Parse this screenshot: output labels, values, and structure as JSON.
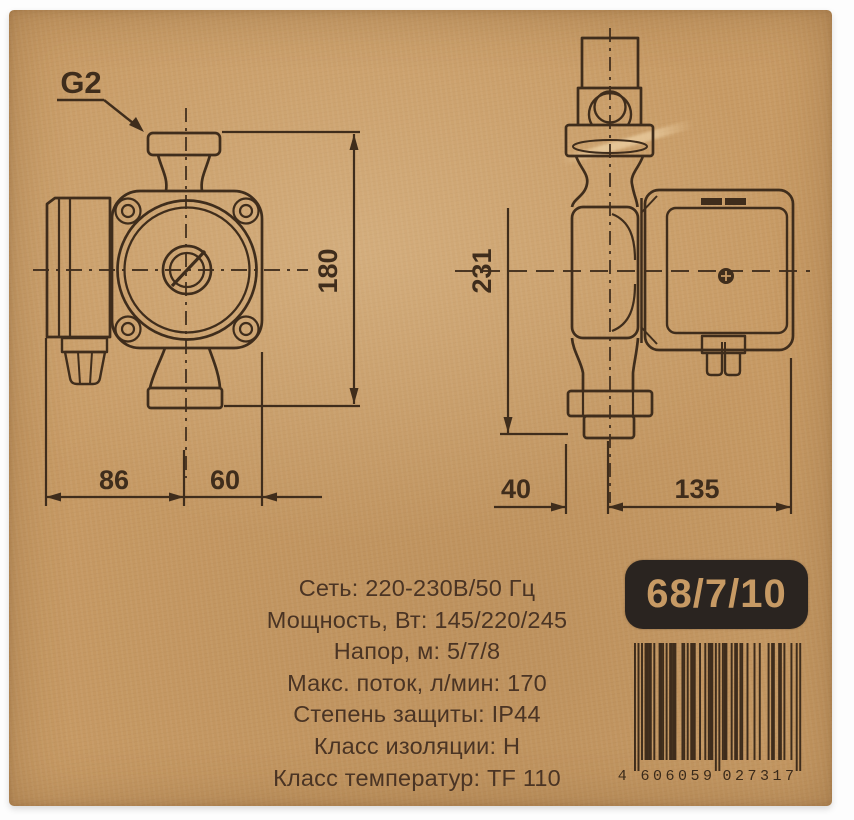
{
  "package": {
    "front_view": {
      "thread_label": "G2",
      "dim_height": "180",
      "dim_left": "86",
      "dim_right": "60"
    },
    "side_view": {
      "dim_height": "231",
      "dim_left": "40",
      "dim_right": "135"
    }
  },
  "specs": {
    "lines": [
      "Сеть: 220-230В/50 Гц",
      "Мощность, Вт: 145/220/245",
      "Напор, м: 5/7/8",
      "Макс. поток, л/мин: 170",
      "Степень защиты: IP44",
      "Класс изоляции: Н",
      "Класс температур: TF 110"
    ]
  },
  "model_badge": "68/7/10",
  "barcode": {
    "groups": [
      "4",
      "606059",
      "027317"
    ],
    "segments": [
      "101",
      "0101111",
      "0100111",
      "0101111",
      "0001101",
      "0111001",
      "0010111",
      "01010",
      "1110010",
      "1101100",
      "1000100",
      "1000010",
      "1100110",
      "1000100",
      "101"
    ],
    "guard_segments": [
      0,
      7,
      14
    ]
  },
  "colors": {
    "cardboard": "#c79a64",
    "ink": "#3f2d1c",
    "badge_bg": "#2a2420",
    "badge_text": "#c79a64",
    "spec_text": "#4a3424"
  }
}
